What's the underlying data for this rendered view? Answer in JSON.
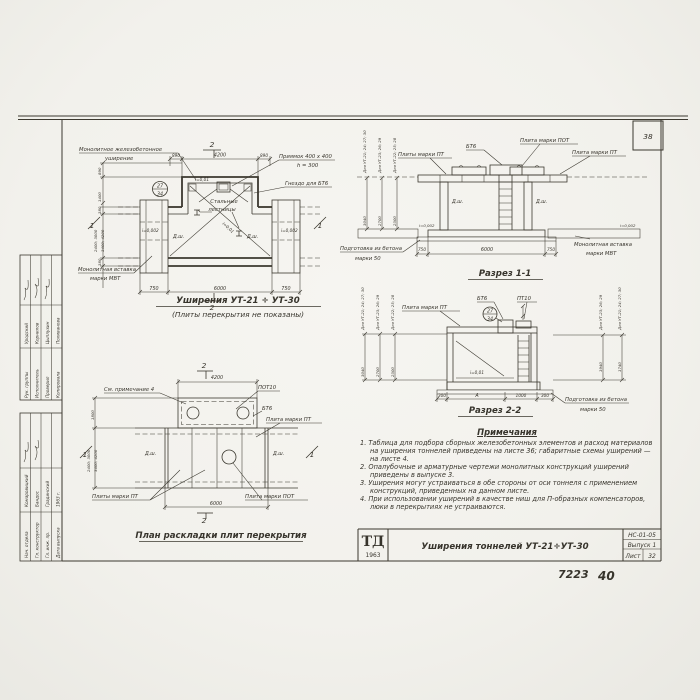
{
  "paper_color": "#f4f3ef",
  "ink_color": "#3b382f",
  "sheet": {
    "corner_number": "38",
    "doc_number": "7223",
    "page_number": "40"
  },
  "stamp": {
    "upper": [
      {
        "role": "Рук. группы",
        "name": "Уродский"
      },
      {
        "role": "Исполнитель",
        "name": "Корнилов"
      },
      {
        "role": "Проверил",
        "name": "Цыплухин"
      },
      {
        "role": "Копировала",
        "name": "Поливанова"
      }
    ],
    "lower": [
      {
        "role": "Нач. отдела",
        "name": "Комаровицкий"
      },
      {
        "role": "Гл. конструктор",
        "name": "Бандос"
      },
      {
        "role": "Гл. инж. пр.",
        "name": "Градинский"
      },
      {
        "role": "Дата выпуска",
        "name": "1963 г."
      }
    ]
  },
  "plan_top": {
    "title": "Уширения УТ-21 ÷ УТ-30",
    "subtitle": "(Плиты перекрытия не показаны)",
    "callout_widening_1": "Монолитное железобетонное",
    "callout_widening_2": "уширение",
    "callout_pit_1": "Приямок 400 х 400",
    "callout_pit_2": "h = 300",
    "callout_socket": "Гнездо для БТ6",
    "callout_ladder_1": "Стальные",
    "callout_ladder_2": "лестницы",
    "callout_insert_1": "Монолитная вставка",
    "callout_insert_2": "марки МВТ",
    "detail_top": "27",
    "detail_bottom": "34",
    "slope_small": "i=0,01",
    "slope_tiny": "i=0,002",
    "joint": "Д.ш.",
    "dim_890": "890",
    "dim_4200": "4200",
    "dim_750": "750",
    "dim_6000": "6000",
    "dims_left": [
      "890",
      "1400",
      "380",
      "2400; 3000",
      "3400; 4200",
      "380"
    ],
    "mark1": "1",
    "mark2": "2"
  },
  "section1": {
    "title": "Разрез 1-1",
    "bt6": "БТ6",
    "pot": "Плита марки ПОТ",
    "pt_left": "Плиты марки ПТ",
    "pt_right": "Плита марки ПТ",
    "prep1": "Подготовка из бетона",
    "prep2": "марки 50",
    "insert1": "Монолитная вставка",
    "insert2": "марки МВТ",
    "joint": "Д.ш.",
    "slope": "i=0,002",
    "for_labels": [
      "Для УТ-21; 24; 27; 30",
      "Для УТ-23; 26; 29",
      "Для УТ-22; 25; 28"
    ],
    "vdims": [
      "3040",
      "2700",
      "2300"
    ],
    "dim_750": "750",
    "dim_6000": "6000"
  },
  "section2": {
    "title": "Разрез 2-2",
    "pt": "Плита марки ПТ",
    "bt6": "БТ6",
    "pt10": "ПТ10",
    "detail_top": "27",
    "detail_bottom": "34",
    "slope": "i=0,01",
    "prep1": "Подготовка из бетона",
    "prep2": "марки 50",
    "for_left": [
      "Для УТ-21; 24; 27; 30",
      "Для УТ-23; 26; 29",
      "Для УТ-22; 25; 28"
    ],
    "vdims_left": [
      "3040",
      "2700",
      "2300"
    ],
    "for_right": [
      "Для УТ-23; 26; 29",
      "Для УТ-21; 24; 27; 30"
    ],
    "vdims_right": [
      "1940",
      "1740"
    ],
    "dims_bottom": [
      "300",
      "А",
      "1000",
      "300"
    ]
  },
  "plan_bottom": {
    "title": "План раскладки плит перекрытия",
    "note_ref": "См. примечание 4",
    "pot10": "ПОТ10",
    "bt6": "БТ6",
    "pt_right": "Плита марки ПТ",
    "pt_bottom": "Плиты марки ПТ",
    "pot_bottom": "Плита марки ПОТ",
    "joint": "Д.ш.",
    "dim_4200": "4200",
    "dim_6000": "6000",
    "dims_left": [
      "1800",
      "2400; 3000",
      "3400; 4200"
    ],
    "mark1": "1",
    "mark2": "2"
  },
  "notes": {
    "title": "Примечания",
    "items": [
      "1. Таблица для подбора сборных железобетонных элементов и расход материалов на уширения тоннелей приведены на листе 36; габаритные схемы уширений — на листе 4.",
      "2. Опалубочные и арматурные чертежи монолитных конструкций уширений приведены в выпуске 3.",
      "3. Уширения могут устраиваться в обе стороны от оси тоннеля с применением конструкций, приведенных на данном листе.",
      "4. При использовании уширений в качестве ниш для П-образных компенсаторов, люки в перекрытиях не устраиваются."
    ]
  },
  "titleblock": {
    "logo": "ТД",
    "year": "1963",
    "title": "Уширения тоннелей УТ-21÷УТ-30",
    "code": "НС-01-05",
    "issue": "Выпуск 1",
    "sheet_label": "Лист",
    "sheet_number": "32"
  }
}
